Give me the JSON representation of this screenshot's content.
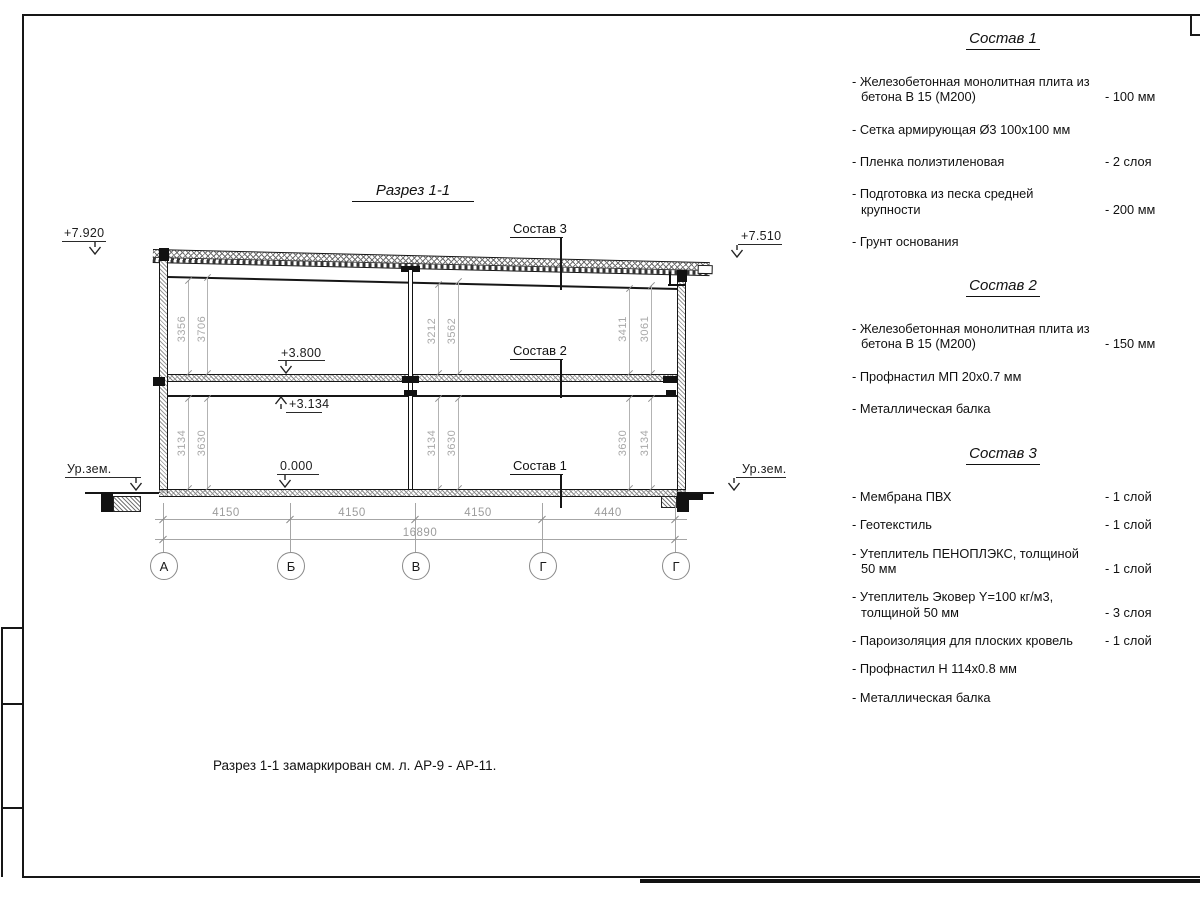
{
  "drawing": {
    "title": "Разрез 1-1",
    "note": "Разрез 1-1 замаркирован см. л. АР-9 - АР-11.",
    "labels": {
      "sostav1": "Состав 1",
      "sostav2": "Состав 2",
      "sostav3": "Состав 3",
      "elev_roof_left": "+7.920",
      "elev_roof_right": "+7.510",
      "elev_floor": "+3.800",
      "elev_beam": "+3.134",
      "elev_zero": "0.000",
      "ground_left": "Ур.зем.",
      "ground_right": "Ур.зем."
    },
    "dims_upper": [
      [
        "3356",
        "3706"
      ],
      [
        "3212",
        "3562"
      ],
      [
        "3411",
        "3061"
      ]
    ],
    "dims_lower": [
      [
        "3134",
        "3630"
      ],
      [
        "3134",
        "3630"
      ],
      [
        "3630",
        "3134"
      ]
    ],
    "dims_bottom": [
      "4150",
      "4150",
      "4150",
      "4440"
    ],
    "dim_total": "16890",
    "axes": [
      "А",
      "Б",
      "В",
      "Г",
      "Г"
    ]
  },
  "panels": [
    {
      "heading": "Состав 1",
      "items": [
        {
          "label": "- Железобетонная монолитная плита из бетона В 15 (М200)",
          "value": "- 100 мм"
        },
        {
          "label": "- Сетка армирующая Ø3 100x100 мм"
        },
        {
          "label": "- Пленка полиэтиленовая",
          "value": "- 2 слоя"
        },
        {
          "label": "- Подготовка из песка средней крупности",
          "value": "- 200 мм"
        },
        {
          "label": "- Грунт основания"
        }
      ]
    },
    {
      "heading": "Состав 2",
      "items": [
        {
          "label": "- Железобетонная монолитная плита из бетона В 15 (М200)",
          "value": "- 150 мм"
        },
        {
          "label": "- Профнастил МП 20x0.7 мм"
        },
        {
          "label": "- Металлическая балка"
        }
      ]
    },
    {
      "heading": "Состав 3",
      "items": [
        {
          "label": "- Мембрана ПВХ",
          "value": "- 1 слой"
        },
        {
          "label": "- Геотекстиль",
          "value": "- 1 слой"
        },
        {
          "label": "- Утеплитель ПЕНОПЛЭКС, толщиной 50 мм",
          "value": "- 1 слой"
        },
        {
          "label": "- Утеплитель Эковер Y=100 кг/м3, толщиной 50 мм",
          "value": "- 3 слоя"
        },
        {
          "label": "- Пароизоляция для плоских кровель",
          "value": "- 1 слой"
        },
        {
          "label": "- Профнастил Н 114x0.8 мм"
        },
        {
          "label": "- Металлическая балка"
        }
      ]
    }
  ]
}
